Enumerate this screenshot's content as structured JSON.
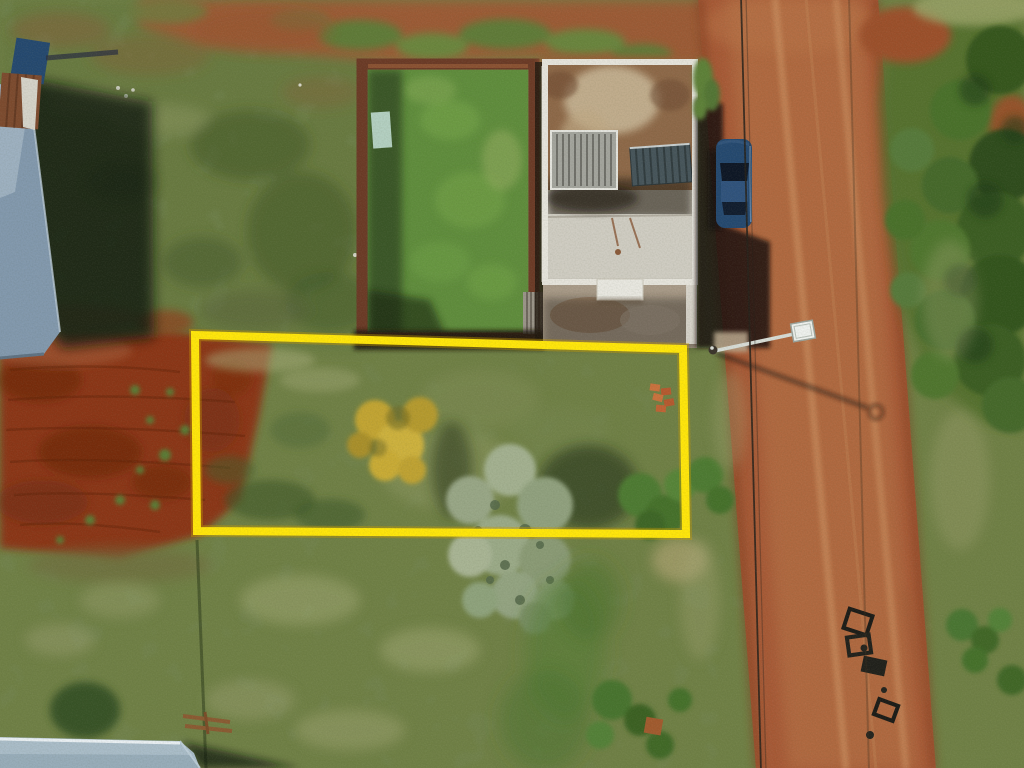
{
  "scene": {
    "type": "aerial-drone-photo",
    "subject": "vacant-land-parcel-outlined-in-yellow",
    "objects": [
      "property-boundary-highlight",
      "dirt-road",
      "parked-car",
      "house-under-construction",
      "water-tank",
      "stair-roof",
      "walled-grass-yard",
      "tilled-red-soil",
      "street-lamp",
      "power-lines",
      "top-left-metal-roof",
      "bottom-left-metal-roof",
      "yellow-flowering-tree",
      "sage-tree",
      "green-trees",
      "burned-debris",
      "grass-field"
    ]
  },
  "colors": {
    "grass_base": "#6f7f45",
    "grass_top_left": "#68793f",
    "walled_grass": "#5f8c3c",
    "dirt_red": "#8a3518",
    "road": "#a65936",
    "vegetation": "#55702f",
    "brick_wall": "#6b3a26",
    "building_slab": "#cac7bd",
    "building_parapet": "#e6e4dc",
    "slab_stain": "#8d6848",
    "water_tank": "#a3a49d",
    "stair_roof": "#46545a",
    "car_body": "#24486f",
    "roof_top_left": "#8298ad",
    "roof_bottom_left": "#a9bcc8",
    "highlight": "#ffe60a",
    "highlight_edge": "#c79a00",
    "lamp": "#eef1ee",
    "shadow": "#120e08"
  }
}
